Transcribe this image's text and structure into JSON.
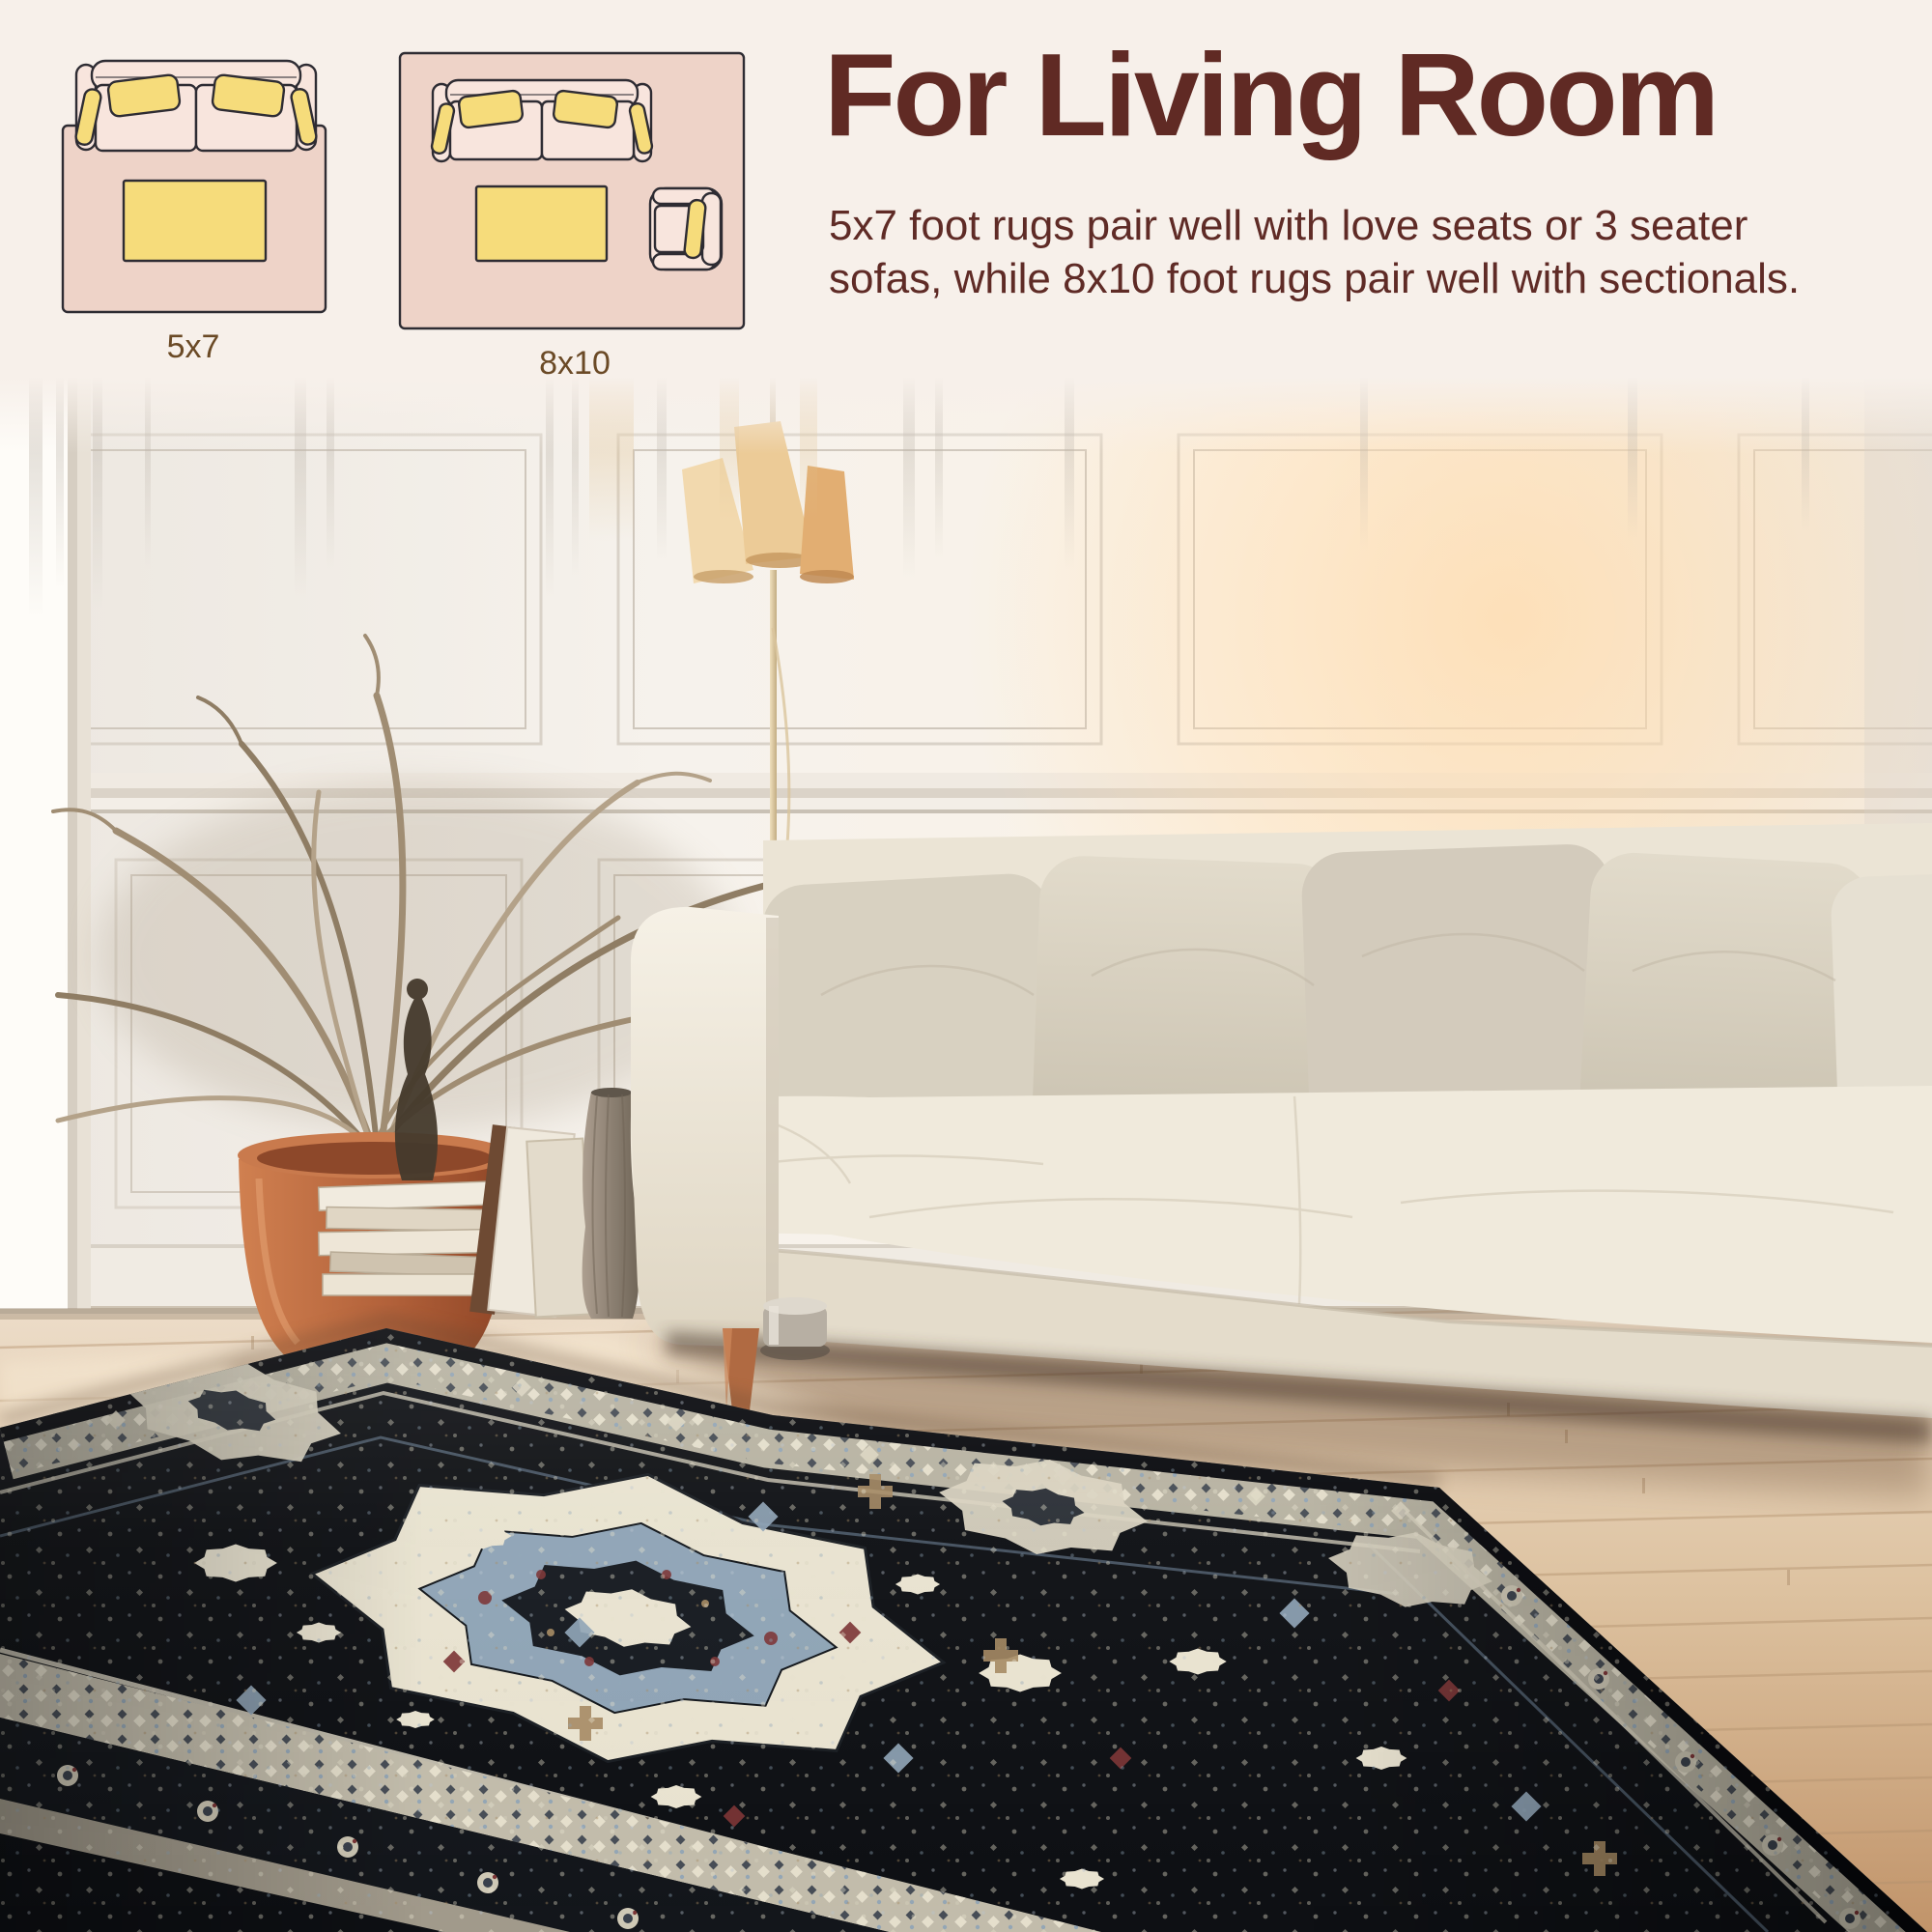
{
  "header": {
    "title": "For Living Room",
    "description_line1": "5x7 foot rugs pair well with love seats or 3 seater",
    "description_line2": "sofas, while 8x10 foot rugs pair well with sectionals."
  },
  "diagrams": {
    "items": [
      {
        "id": "5x7",
        "label": "5x7",
        "shows": "loveseat sofa with coffee table on rug"
      },
      {
        "id": "8x10",
        "label": "8x10",
        "shows": "3 seater sofa with coffee table and armchair on rug"
      }
    ]
  },
  "photo": {
    "scene": "living-room",
    "objects": [
      "white paneled wall",
      "tall bright window",
      "dried palm plant in terracotta pot",
      "stack of books",
      "leaning canvases",
      "striped vase",
      "dark statuette",
      "floor lamp with three cone shades",
      "cream sofa with beige pillows",
      "light wood plank floor",
      "black persian medallion rug"
    ]
  },
  "palette": {
    "cream": "#f7f0ea",
    "heading": "#602a24",
    "text": "#5f2b26",
    "label": "#6b4a26",
    "outline": "#2e2c33",
    "dpink": "#eed3c8",
    "dsofa": "#f8e5dd",
    "daccent": "#f6dc7b",
    "terracotta": "#b2613a",
    "frond": "#9b8a70",
    "sofa": "#eee8da",
    "pillow": "#d8d1c1",
    "leg": "#b06a42",
    "chrome": "#b7afa3",
    "rugblack": "#0e1014",
    "rugborder": "#c6c0ae",
    "rugivory": "#e9e3d0",
    "rugblue": "#8fa4b6",
    "rugred": "#7c3536",
    "rugtan": "#a58a62"
  }
}
